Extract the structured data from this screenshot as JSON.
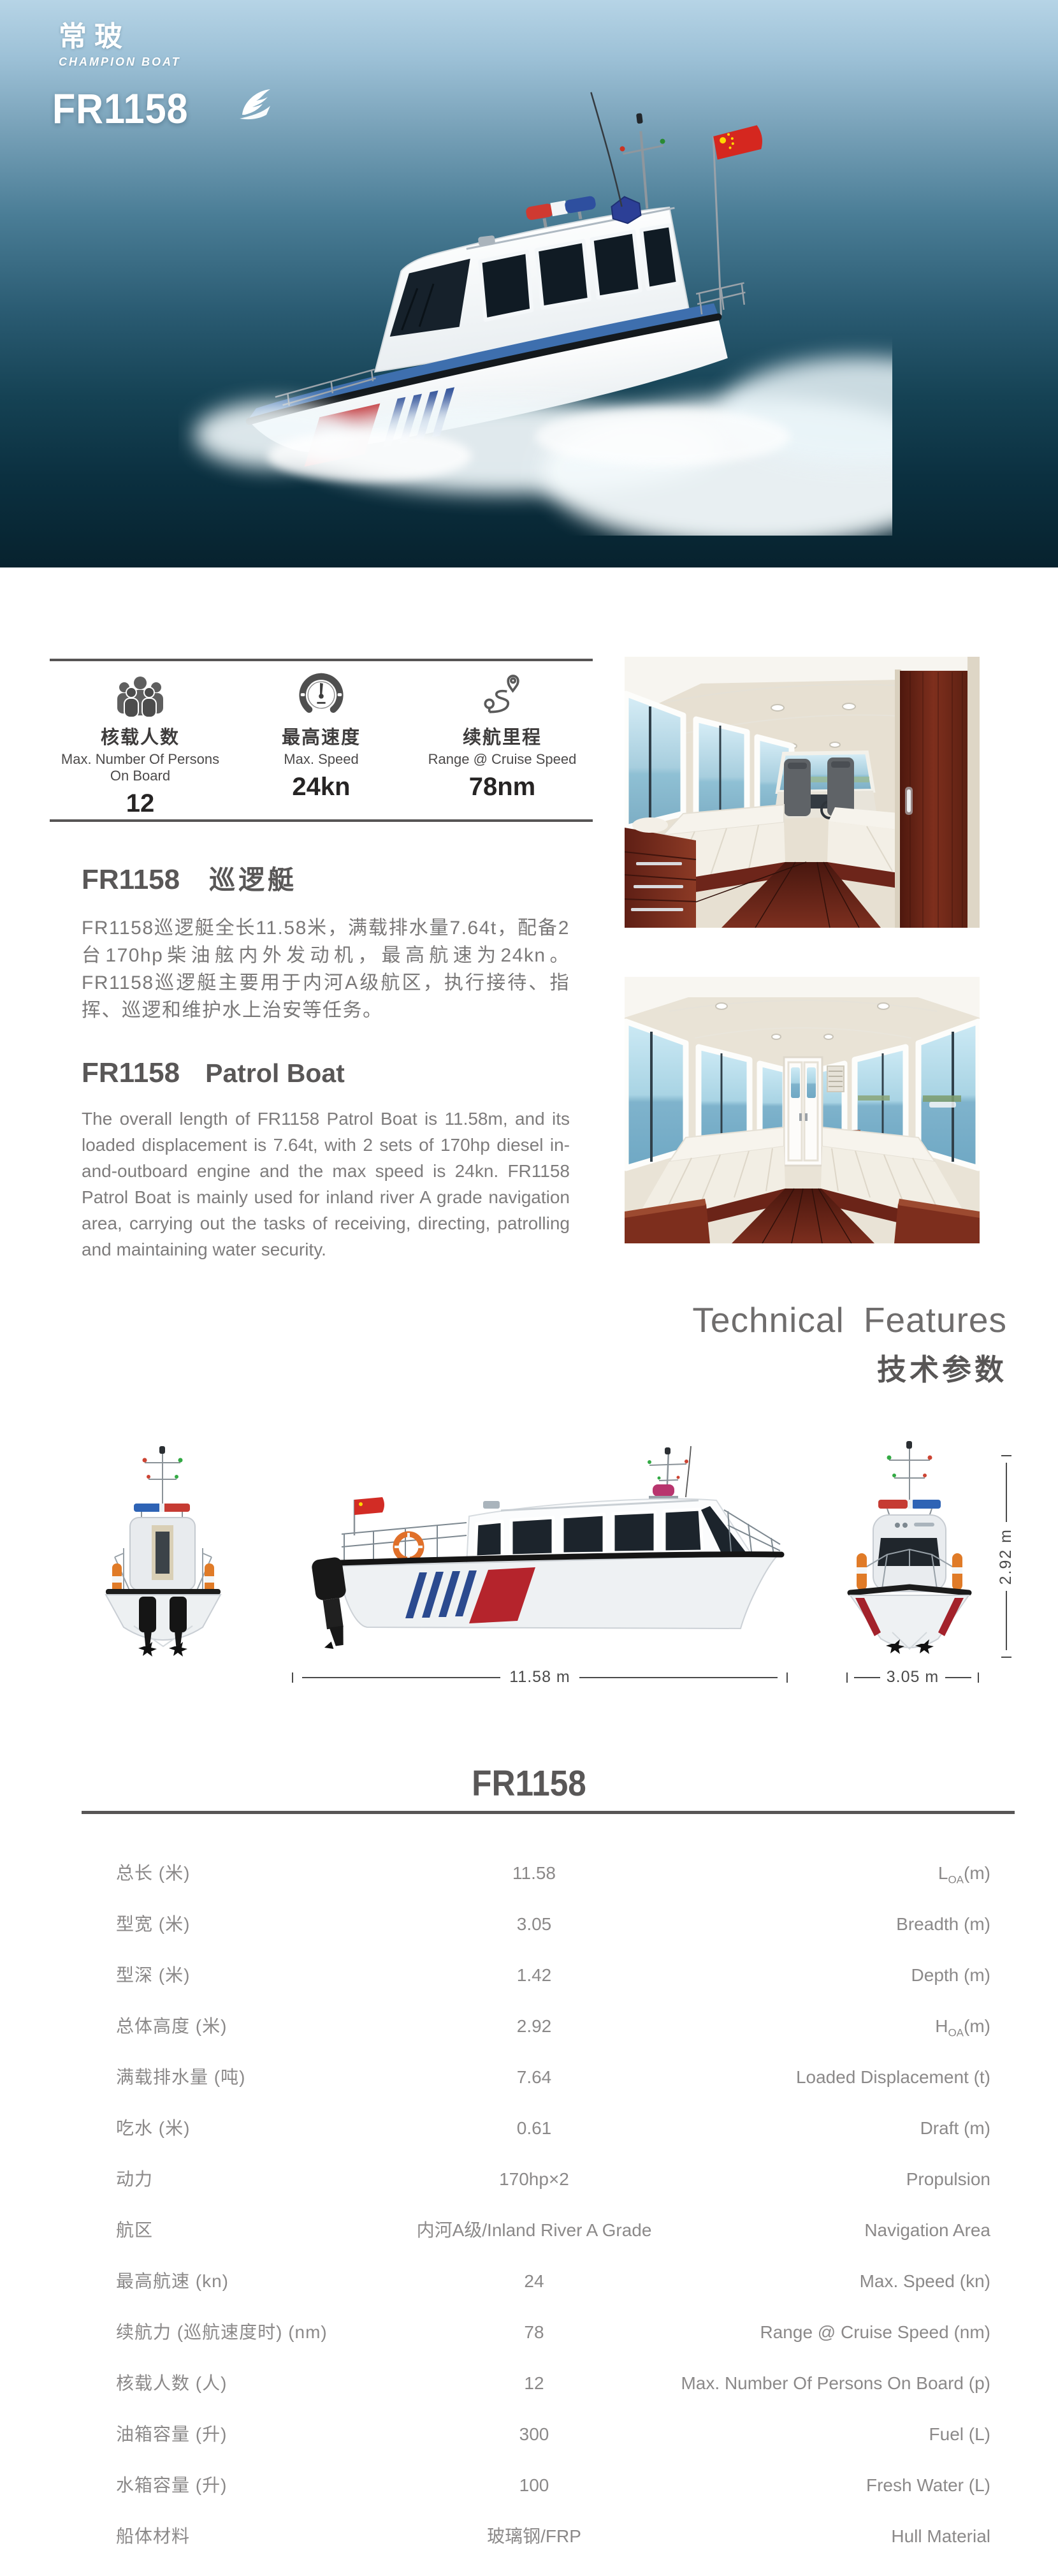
{
  "hero": {
    "brand_cn": "常玻",
    "brand_en": "CHAMPION BOAT",
    "model": "FR1158"
  },
  "strip": {
    "items": [
      {
        "icon": "persons-group-icon",
        "zh": "核载人数",
        "en": "Max. Number Of Persons On Board",
        "value": "12"
      },
      {
        "icon": "speedometer-icon",
        "zh": "最高速度",
        "en": "Max. Speed",
        "value": "24kn"
      },
      {
        "icon": "route-icon",
        "zh": "续航里程",
        "en": "Range @ Cruise Speed",
        "value": "78nm"
      }
    ]
  },
  "intro_cn": {
    "model": "FR1158",
    "name": "巡逻艇",
    "body": "FR1158巡逻艇全长11.58米，满载排水量7.64t，配备2台170hp柴油舷内外发动机，最高航速为24kn。FR1158巡逻艇主要用于内河A级航区，执行接待、指挥、巡逻和维护水上治安等任务。"
  },
  "intro_en": {
    "model": "FR1158",
    "name": "Patrol Boat",
    "body": "The overall length of FR1158 Patrol Boat is 11.58m, and its loaded displacement is 7.64t, with 2 sets of 170hp diesel in-and-outboard engine and the max speed is 24kn. FR1158 Patrol Boat is mainly used for inland river A grade navigation area, carrying out the tasks of receiving, directing, patrolling and maintaining water security."
  },
  "tech_features": {
    "en": "Technical Features",
    "zh": "技术参数"
  },
  "drawings": {
    "length_dim": "11.58 m",
    "beam_dim": "3.05 m",
    "height_dim": "2.92 m"
  },
  "specs": {
    "title": "FR1158",
    "rows": [
      {
        "zh": "总长 (米)",
        "value": "11.58",
        "en": "L~OA~(m)"
      },
      {
        "zh": "型宽 (米)",
        "value": "3.05",
        "en": "Breadth (m)"
      },
      {
        "zh": "型深 (米)",
        "value": "1.42",
        "en": "Depth (m)"
      },
      {
        "zh": "总体高度 (米)",
        "value": "2.92",
        "en": "H~OA~(m)"
      },
      {
        "zh": "满载排水量 (吨)",
        "value": "7.64",
        "en": "Loaded Displacement (t)"
      },
      {
        "zh": "吃水 (米)",
        "value": "0.61",
        "en": "Draft (m)"
      },
      {
        "zh": "动力",
        "value": "170hp×2",
        "en": "Propulsion"
      },
      {
        "zh": "航区",
        "value": "内河A级/Inland River A Grade",
        "en": "Navigation Area"
      },
      {
        "zh": "最高航速 (kn)",
        "value": "24",
        "en": "Max. Speed (kn)"
      },
      {
        "zh": "续航力 (巡航速度时) (nm)",
        "value": "78",
        "en": "Range @ Cruise Speed (nm)"
      },
      {
        "zh": "核载人数 (人)",
        "value": "12",
        "en": "Max. Number Of Persons On Board (p)"
      },
      {
        "zh": "油箱容量 (升)",
        "value": "300",
        "en": "Fuel (L)"
      },
      {
        "zh": "水箱容量 (升)",
        "value": "100",
        "en": "Fresh Water (L)"
      },
      {
        "zh": "船体材料",
        "value": "玻璃钢/FRP",
        "en": "Hull Material"
      }
    ]
  }
}
